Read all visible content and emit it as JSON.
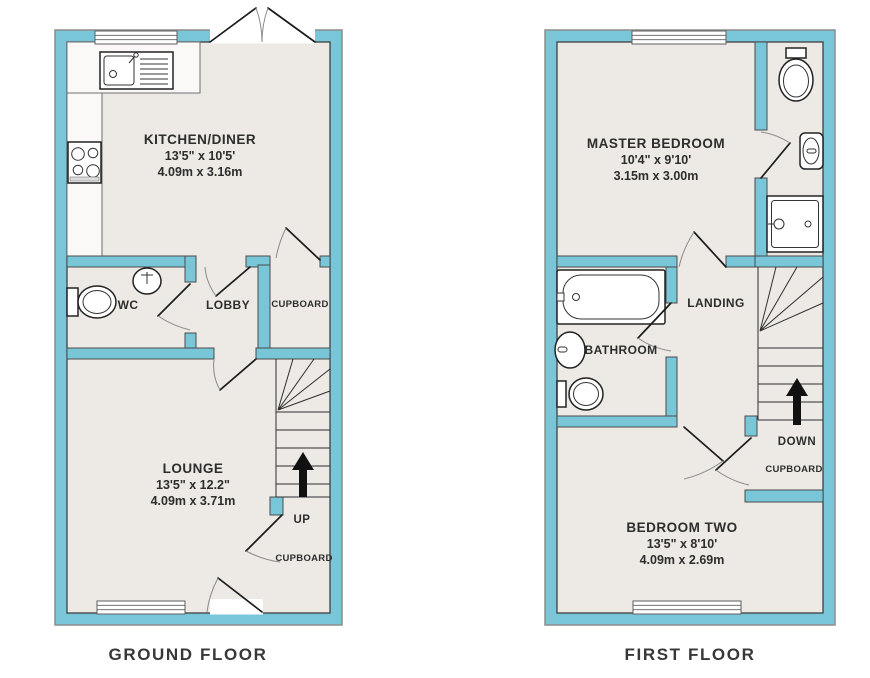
{
  "colors": {
    "wall": "#79c6d9",
    "floor": "#edeae5",
    "counter": "#faf9f7",
    "outline": "#3f3f3f",
    "arrow": "#111111"
  },
  "ground_floor": {
    "caption": "GROUND FLOOR",
    "kitchen": {
      "name": "KITCHEN/DINER",
      "imperial": "13'5\" x 10'5'",
      "metric": "4.09m x 3.16m"
    },
    "wc": {
      "name": "WC"
    },
    "lobby": {
      "name": "LOBBY"
    },
    "cupboard": {
      "name": "CUPBOARD"
    },
    "lounge": {
      "name": "LOUNGE",
      "imperial": "13'5\" x 12.2\"",
      "metric": "4.09m x 3.71m"
    },
    "stairs": {
      "label": "UP"
    },
    "stairs_cupboard": {
      "name": "CUPBOARD"
    }
  },
  "first_floor": {
    "caption": "FIRST FLOOR",
    "master_bedroom": {
      "name": "MASTER BEDROOM",
      "imperial": "10'4\" x 9'10'",
      "metric": "3.15m x 3.00m"
    },
    "landing": {
      "name": "LANDING"
    },
    "bathroom": {
      "name": "BATHROOM"
    },
    "stairs": {
      "label": "DOWN"
    },
    "cupboard": {
      "name": "CUPBOARD"
    },
    "bedroom_two": {
      "name": "BEDROOM TWO",
      "imperial": "13'5\" x 8'10'",
      "metric": "4.09m x 2.69m"
    }
  }
}
